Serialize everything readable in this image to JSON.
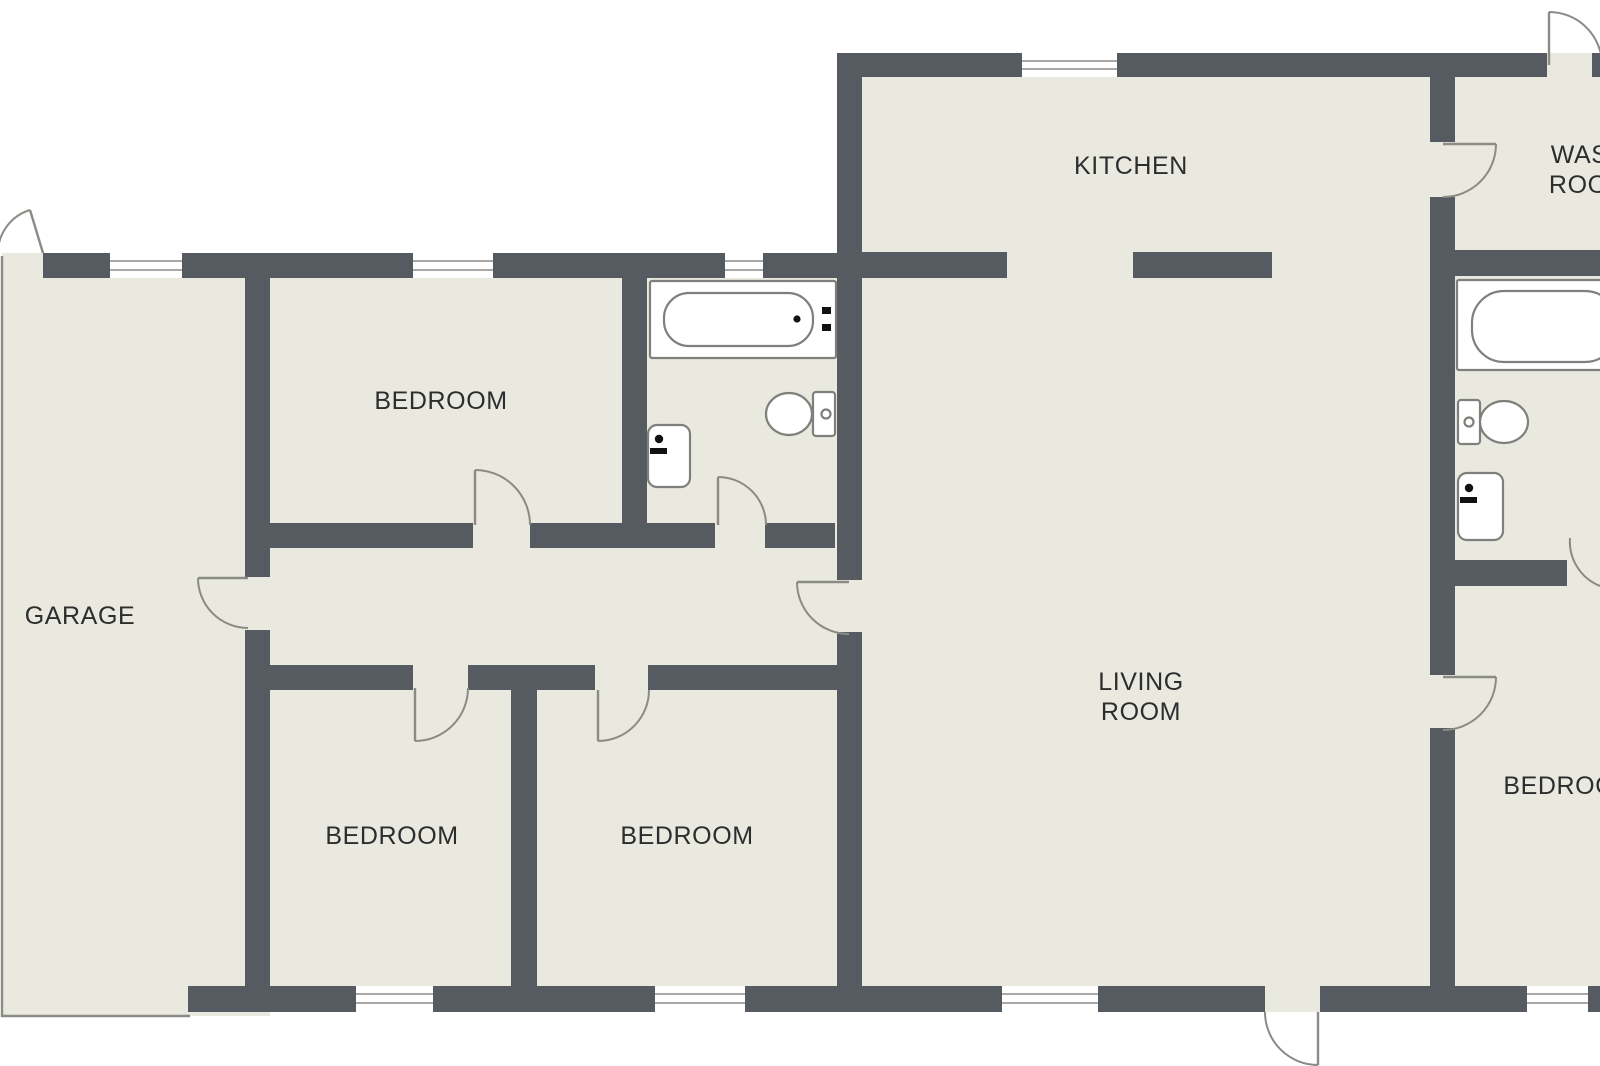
{
  "plan_title": "Single-storey house floor plan",
  "colors": {
    "wall": "#565b62",
    "floor": "#e9e9e0",
    "line": "#8b8b85",
    "fixture": "#7d807b",
    "text": "#2d2d2d",
    "bg": "#ffffff"
  },
  "rooms": {
    "garage": {
      "label": "GARAGE"
    },
    "bedroom_top_left": {
      "label": "BEDROOM"
    },
    "bedroom_bottom_left": {
      "label": "BEDROOM"
    },
    "bedroom_bottom_middle": {
      "label": "BEDROOM"
    },
    "bedroom_right": {
      "label": "BEDROOM"
    },
    "kitchen": {
      "label": "KITCHEN"
    },
    "living_room": {
      "label": "LIVING\nROOM"
    },
    "wash_room": {
      "label": "WASH\nROOM"
    }
  },
  "fixtures": {
    "bathroom_top": [
      "bathtub-icon",
      "toilet-icon",
      "sink-icon"
    ],
    "bathroom_right": [
      "bathtub-icon",
      "toilet-icon",
      "sink-icon"
    ]
  },
  "openings": {
    "window_count": 8,
    "door_count": 12
  }
}
